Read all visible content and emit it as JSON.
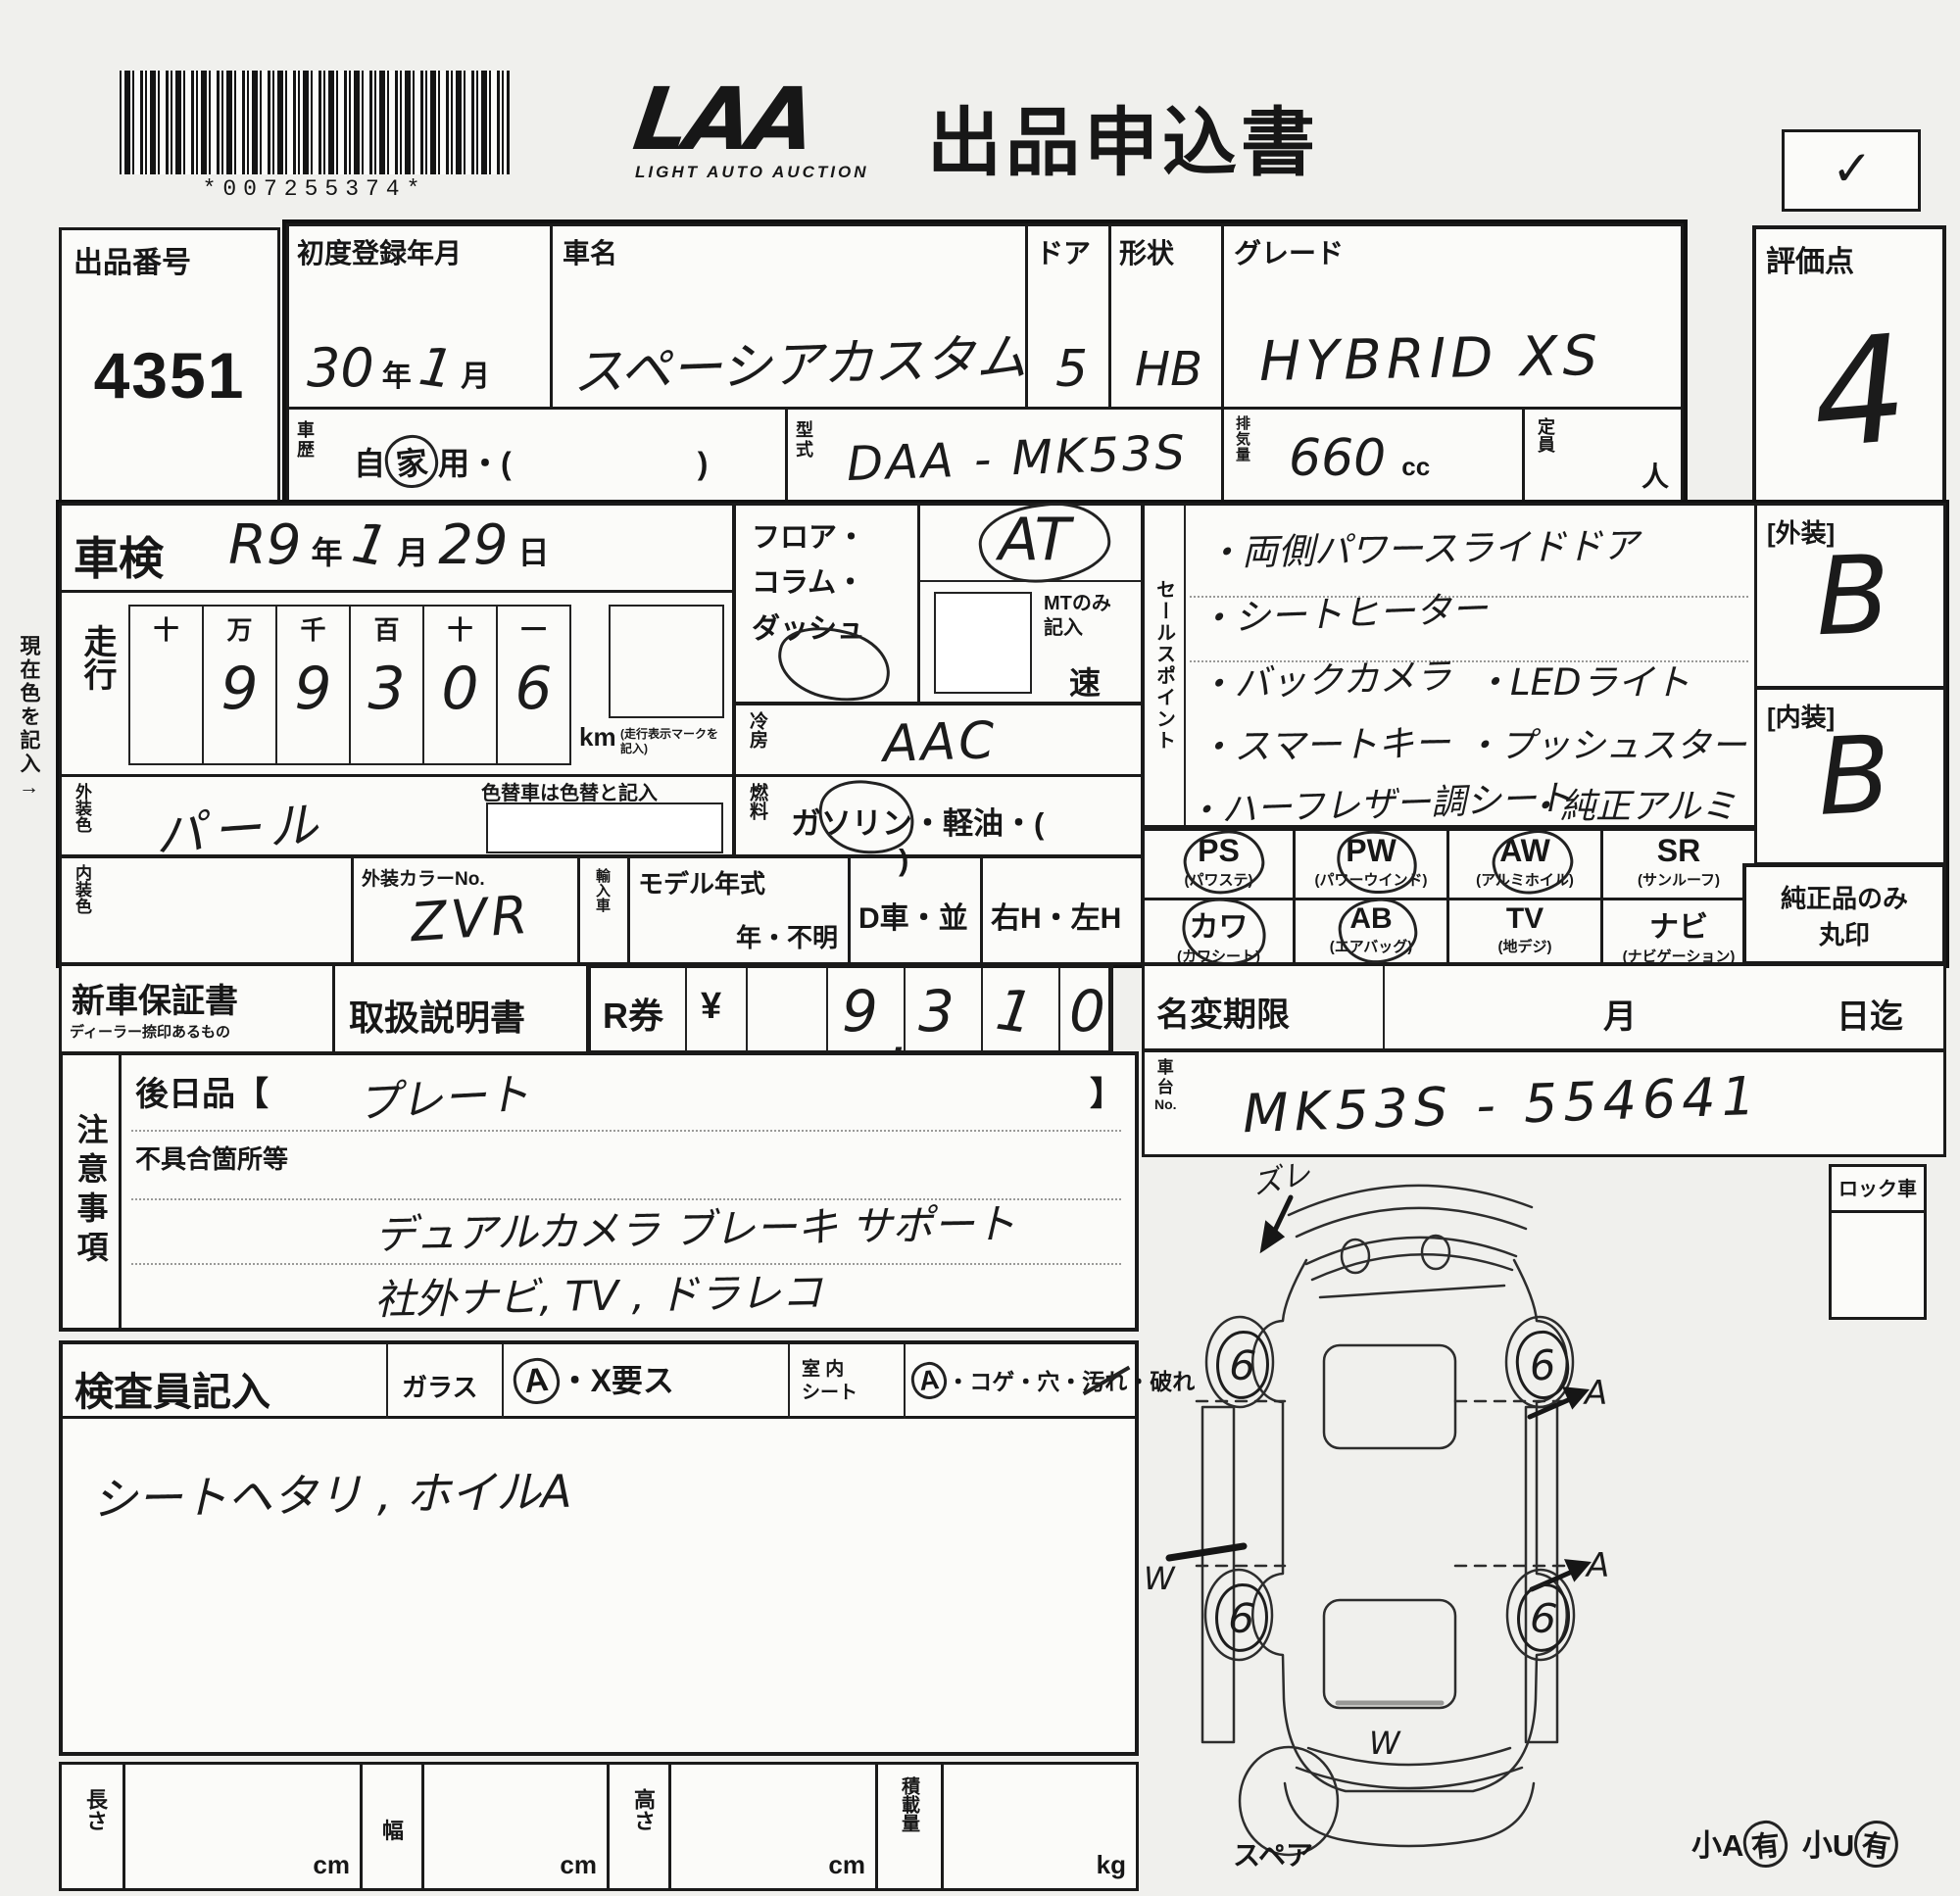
{
  "header": {
    "barcode_text": "*007255374*",
    "logo_main": "LAA",
    "logo_sub": "LIGHT AUTO AUCTION",
    "title": "出品申込書",
    "checkmark": "✓"
  },
  "margin_note": "現在色を記入→",
  "lot": {
    "label": "出品番号",
    "value": "4351"
  },
  "registration": {
    "label": "初度登録年月",
    "year": "30",
    "year_unit": "年",
    "month": "1",
    "month_unit": "月"
  },
  "car_name": {
    "label": "車名",
    "value": "スペーシアカスタム"
  },
  "doors": {
    "label": "ドア",
    "value": "5"
  },
  "shape": {
    "label": "形状",
    "value": "HB"
  },
  "grade": {
    "label": "グレード",
    "value": "HYBRID XS"
  },
  "score": {
    "label": "評価点",
    "value": "4"
  },
  "history": {
    "label_1": "車",
    "label_2": "歴",
    "pre": "自",
    "circled": "家",
    "post": "用・(",
    "close": ")"
  },
  "model_code": {
    "label_1": "型",
    "label_2": "式",
    "value": "DAA - MK53S"
  },
  "displacement": {
    "label": "排気量",
    "value": "660",
    "unit": "cc"
  },
  "capacity": {
    "label": "定員",
    "unit": "人"
  },
  "shaken": {
    "label": "車検",
    "era": "R9",
    "year_unit": "年",
    "month": "1",
    "month_unit": "月",
    "day": "29",
    "day_unit": "日"
  },
  "mileage": {
    "label": "走行",
    "headers": [
      "十",
      "万",
      "千",
      "百",
      "十",
      "一"
    ],
    "digits": [
      "",
      "9",
      "9",
      "3",
      "0",
      "6"
    ],
    "unit": "km",
    "unit_note": "(走行表示マークを記入)"
  },
  "color_change_note": "色替車は色替と記入",
  "exterior_color": {
    "label": "外装色",
    "value": "パール"
  },
  "interior_color": {
    "label": "内装色",
    "value": ""
  },
  "color_no": {
    "label": "外装カラーNo.",
    "value": "ZVR"
  },
  "import_car": {
    "label": "輸入車",
    "model_year_label": "モデル年式",
    "year_unknown": "年・不明"
  },
  "d_car": "D車・並",
  "handle": "右H・左H",
  "transmission": {
    "floor_line1": "フロア・",
    "floor_line2": "コラム・",
    "floor_line3": "ダッシュ",
    "at_value": "AT",
    "mt_note_1": "MTのみ",
    "mt_note_2": "記入",
    "speed_unit": "速"
  },
  "ac": {
    "label": "冷房",
    "value": "AAC"
  },
  "fuel": {
    "label": "燃料",
    "p1": "ガ",
    "circled": "ソリ",
    "p2": "ン・軽油・(",
    "close": ")"
  },
  "sales_points": {
    "label": "セールスポイント",
    "rows": [
      {
        "left": "・両側パワースライドドア",
        "right": ""
      },
      {
        "left": "・シートヒーター",
        "right": ""
      },
      {
        "left": "・バックカメラ",
        "right": "・LEDライト"
      },
      {
        "left": "・スマートキー",
        "right": "・プッシュスタート"
      },
      {
        "left": "・ハーフレザー調シート",
        "right": "・純正アルミ"
      }
    ]
  },
  "equipment": [
    {
      "code": "PS",
      "name": "(パワステ)",
      "circled": true
    },
    {
      "code": "PW",
      "name": "(パワーウインド)",
      "circled": true
    },
    {
      "code": "AW",
      "name": "(アルミホイル)",
      "circled": true
    },
    {
      "code": "SR",
      "name": "(サンルーフ)",
      "circled": false
    },
    {
      "code": "カワ",
      "name": "(カワシート)",
      "circled": true
    },
    {
      "code": "AB",
      "name": "(エアバッグ)",
      "circled": true
    },
    {
      "code": "TV",
      "name": "(地デジ)",
      "circled": false
    },
    {
      "code": "ナビ",
      "name": "(ナビゲーション)",
      "circled": false
    }
  ],
  "ratings": {
    "exterior_label": "[外装]",
    "exterior_value": "B",
    "interior_label": "[内装]",
    "interior_value": "B",
    "genuine_note_1": "純正品のみ",
    "genuine_note_2": "丸印"
  },
  "warranty": {
    "label": "新車保証書",
    "sub": "ディーラー捺印あるもの"
  },
  "manual": {
    "label": "取扱説明書"
  },
  "r_ticket": {
    "label": "R券",
    "currency": "¥",
    "digit_1": "9",
    "comma": ",",
    "digit_2": "3",
    "digit_3": "1",
    "digit_4": "0",
    "value": "9,310"
  },
  "name_change": {
    "label": "名変期限",
    "month_unit": "月",
    "day_unit": "日迄"
  },
  "chassis": {
    "label_1": "車",
    "label_2": "台",
    "label_3": "No.",
    "value": "MK53S - 554641"
  },
  "notes": {
    "label": "注意事項",
    "later_label": "後日品【",
    "later_value": "プレート",
    "later_close": "】",
    "defect_label": "不具合箇所等",
    "line1": "デュアルカメラ ブレーキ サポート",
    "line2": "社外ナビ, TV , ドラレコ"
  },
  "inspector": {
    "label": "検査員記入",
    "glass_label": "ガラス",
    "glass_circled": "A",
    "glass_rest": "・X要ス",
    "seat_label_1": "室 内",
    "seat_label_2": "シート",
    "seat_circled": "A",
    "seat_pre": "・コゲ・穴・",
    "seat_struck": "汚れ",
    "seat_post": "・破れ",
    "note": "シートヘタリ , ホイルA"
  },
  "dimensions": {
    "length_label": "長さ",
    "length_unit": "cm",
    "width_label": "幅",
    "width_unit": "cm",
    "height_label": "高さ",
    "height_unit": "cm",
    "load_label": "積載量",
    "load_unit": "kg"
  },
  "diagram": {
    "lock_label": "ロック車",
    "spare_label": "スペア",
    "zure_note": "ズレ",
    "wheel_mark_fl": "6",
    "wheel_mark_fr": "6",
    "wheel_mark_rl": "6",
    "wheel_mark_rr": "6",
    "door_mark_front": "A",
    "door_mark_rear": "A",
    "panel_mark_left": "W",
    "panel_mark_rear": "W",
    "small_a": "小A",
    "small_a_mark": "有",
    "small_u": "小U",
    "small_u_mark": "有"
  }
}
